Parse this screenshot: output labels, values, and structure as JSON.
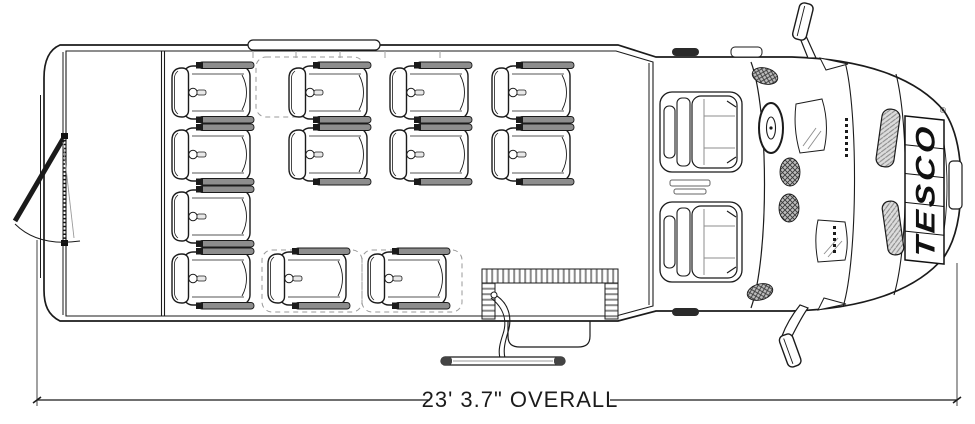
{
  "plan": {
    "title": "shuttle-bus-floor-plan-top-view",
    "dimension_label": "23' 3.7\" OVERALL",
    "brand": "TESCO",
    "registered_mark": "®"
  },
  "seats": {
    "passenger_positions": [
      [
        170,
        62
      ],
      [
        287,
        62
      ],
      [
        388,
        62
      ],
      [
        490,
        62
      ],
      [
        170,
        124
      ],
      [
        287,
        124
      ],
      [
        388,
        124
      ],
      [
        490,
        124
      ],
      [
        170,
        186
      ],
      [
        170,
        248
      ],
      [
        266,
        248
      ],
      [
        366,
        248
      ]
    ],
    "cab_positions": [
      [
        659,
        90
      ],
      [
        659,
        200
      ]
    ]
  },
  "colors": {
    "line": "#1b1b1b",
    "accent_gray": "#8d8d8d",
    "hatch_gray": "#8a8a8a",
    "background": "#ffffff"
  }
}
